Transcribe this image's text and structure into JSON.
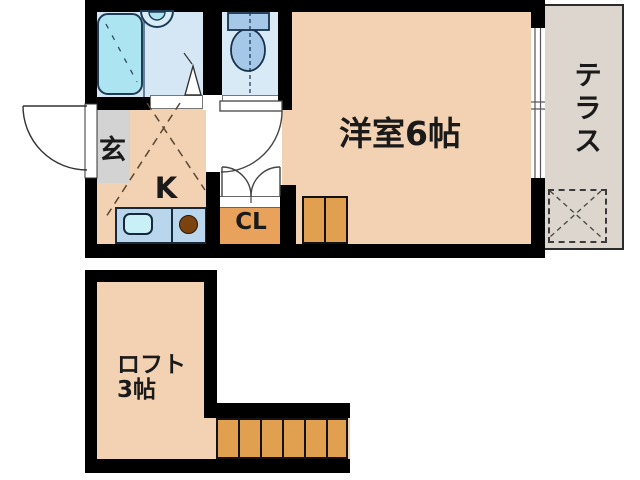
{
  "plan": {
    "upper": {
      "entrance": "玄",
      "kitchen": "K",
      "closet": "CL",
      "room": "洋室6帖",
      "terrace": "テラス"
    },
    "lower": {
      "loft": "ロフト",
      "loft_size": "3帖"
    },
    "colors": {
      "wall": "#000000",
      "room_fill": "#F2D2B2",
      "wet_floor_fill": "#D5E7F4",
      "fixture_fill": "#ACE4F2",
      "counter_fill": "#B9D6EC",
      "stairs_fill": "#E1A04F",
      "closet_fill": "#E9A25B",
      "entrance_fill": "#D3D3D3",
      "terrace_fill": "#DCD6CE",
      "burner": "#7B440F"
    }
  }
}
